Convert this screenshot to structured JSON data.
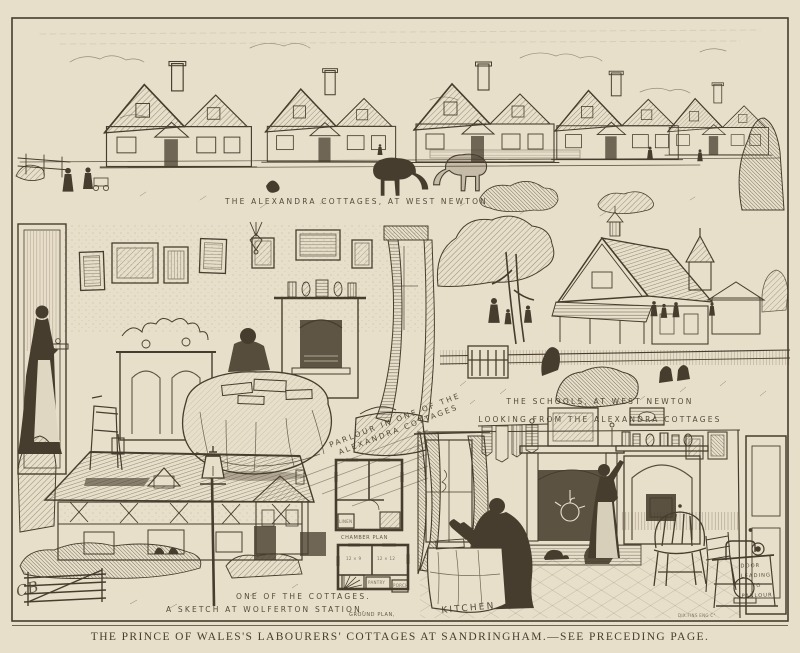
{
  "page": {
    "caption": "THE PRINCE OF WALES'S LABOURERS' COTTAGES AT SANDRINGHAM.—SEE PRECEDING PAGE.",
    "colors": {
      "paper": "#e8dfca",
      "ink": "#473d2e"
    },
    "artist_monogram": "CB"
  },
  "vignettes": {
    "cottages_row": {
      "caption": "THE ALEXANDRA COTTAGES, AT WEST NEWTON"
    },
    "parlour": {
      "caption_line1": "PARLOUR  IN ONE OF THE",
      "caption_line2": "ALEXANDRA COTTAGES"
    },
    "schools": {
      "caption_line1": "THE SCHOOLS, AT WEST NEWTON",
      "caption_line2": "LOOKING FROM THE ALEXANDRA COTTAGES"
    },
    "cottage_sketch": {
      "caption_line1": "ONE OF THE COTTAGES.",
      "caption_line2": "A SKETCH AT WOLFERTON STATION."
    },
    "plans": {
      "chamber_label": "CHAMBER PLAN",
      "ground_label": "GROUND PLAN,",
      "linen_label": "LINEN",
      "pantry_label": "PANTRY",
      "porch_label": "PORCH",
      "dim_left": "12 × 9",
      "dim_right": "12 × 12"
    },
    "kitchen": {
      "caption": "KITCHEN",
      "door_note": [
        "DOOR",
        "LEADING",
        "TO",
        "PARLOUR"
      ],
      "engraver": "DIX.FINS ENG C°"
    }
  }
}
